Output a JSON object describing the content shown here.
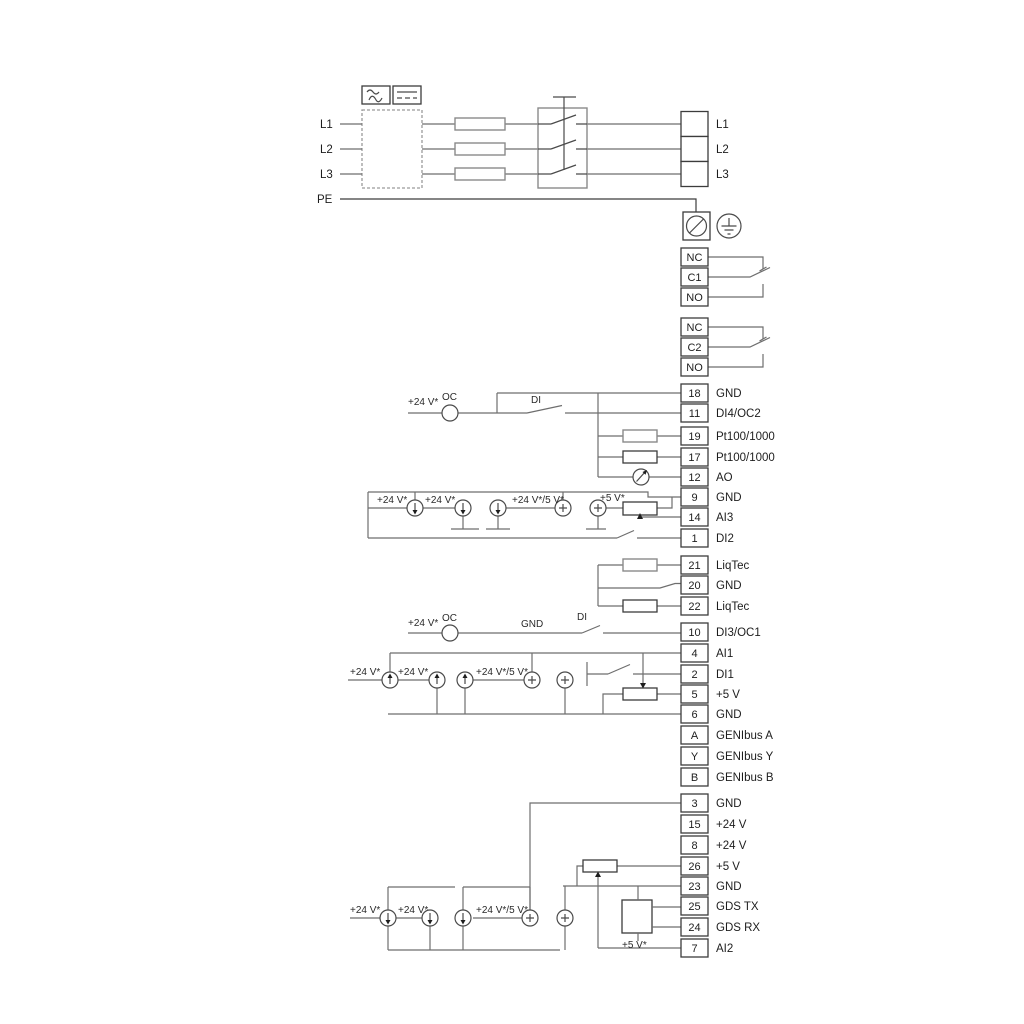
{
  "colors": {
    "wire": "#6e6e6e",
    "ink": "#1d1d1d",
    "background": "#ffffff"
  },
  "power_inputs": {
    "l1": "L1",
    "l2": "L2",
    "l3": "L3",
    "pe": "PE"
  },
  "terminal_groups": {
    "mains": {
      "rows": [
        {
          "cell": "",
          "label": "L1"
        },
        {
          "cell": "",
          "label": "L2"
        },
        {
          "cell": "",
          "label": "L3"
        }
      ]
    },
    "relay1": {
      "rows": [
        {
          "cell": "NC",
          "label": ""
        },
        {
          "cell": "C1",
          "label": ""
        },
        {
          "cell": "NO",
          "label": ""
        }
      ]
    },
    "relay2": {
      "rows": [
        {
          "cell": "NC",
          "label": ""
        },
        {
          "cell": "C2",
          "label": ""
        },
        {
          "cell": "NO",
          "label": ""
        }
      ]
    },
    "strip_main": {
      "rows": [
        {
          "cell": "18",
          "label": "GND"
        },
        {
          "cell": "11",
          "label": "DI4/OC2"
        },
        {
          "cell": "19",
          "label": "Pt100/1000"
        },
        {
          "cell": "17",
          "label": "Pt100/1000"
        },
        {
          "cell": "12",
          "label": "AO"
        },
        {
          "cell": "9",
          "label": "GND"
        },
        {
          "cell": "14",
          "label": "AI3"
        },
        {
          "cell": "1",
          "label": "DI2"
        }
      ]
    },
    "strip_liqtec": {
      "rows": [
        {
          "cell": "21",
          "label": "LiqTec"
        },
        {
          "cell": "20",
          "label": "GND"
        },
        {
          "cell": "22",
          "label": "LiqTec"
        }
      ]
    },
    "strip_io": {
      "rows": [
        {
          "cell": "10",
          "label": "DI3/OC1"
        },
        {
          "cell": "4",
          "label": "AI1"
        },
        {
          "cell": "2",
          "label": "DI1"
        },
        {
          "cell": "5",
          "label": "+5 V"
        },
        {
          "cell": "6",
          "label": "GND"
        },
        {
          "cell": "A",
          "label": "GENIbus A"
        },
        {
          "cell": "Y",
          "label": "GENIbus Y"
        },
        {
          "cell": "B",
          "label": "GENIbus B"
        }
      ]
    },
    "strip_bottom": {
      "rows": [
        {
          "cell": "3",
          "label": "GND"
        },
        {
          "cell": "15",
          "label": "+24 V"
        },
        {
          "cell": "8",
          "label": "+24 V"
        },
        {
          "cell": "26",
          "label": "+5 V"
        },
        {
          "cell": "23",
          "label": "GND"
        },
        {
          "cell": "25",
          "label": "GDS TX"
        },
        {
          "cell": "24",
          "label": "GDS RX"
        },
        {
          "cell": "7",
          "label": "AI2"
        }
      ]
    }
  },
  "ann": {
    "v24": "+24 V*",
    "v24_5": "+24 V*/5 V*",
    "v5": "+5 V*",
    "oc": "OC",
    "di": "DI",
    "gnd": "GND"
  }
}
